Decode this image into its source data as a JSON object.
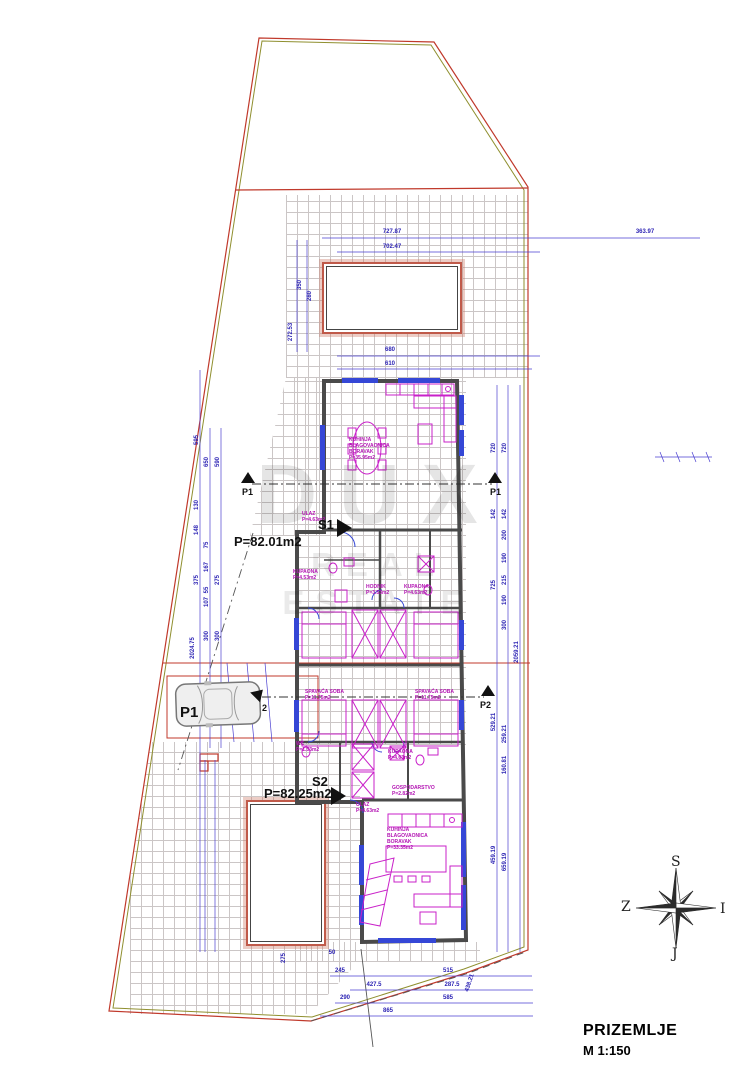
{
  "drawing": {
    "floor_label": "PRIZEMLJE",
    "scale_label": "M 1:150"
  },
  "watermark": {
    "brand": "DUX",
    "tagline": "REAL ESTATE"
  },
  "compass": {
    "north": "S",
    "west": "Z",
    "east": "I",
    "south": "J"
  },
  "units": [
    {
      "id": "S1",
      "area": "P=82.01m2"
    },
    {
      "id": "S2",
      "area": "P=82.25m2"
    }
  ],
  "parking": {
    "space": "P1"
  },
  "sections": {
    "p1": "P1",
    "p2": "P2",
    "entry": "2"
  },
  "colors": {
    "boundary_red": "#c0392b",
    "boundary_olive": "#8f8f2f",
    "wall": "#4a4a4a",
    "furniture": "#c920c9",
    "dimension": "#3d30c4",
    "window": "#3547d6",
    "hatch": "#cbc6c6",
    "watermark": "#cfcfcf"
  },
  "rooms": [
    {
      "t": "KUHINJA\nBLAGOVAONICA\nBORAVAK\nP=35.95m2",
      "x": 349,
      "y": 438
    },
    {
      "t": "ULAZ\nP=4.63m2",
      "x": 302,
      "y": 512
    },
    {
      "t": "KUPAONA\nP=4.53m2",
      "x": 293,
      "y": 570
    },
    {
      "t": "HODNIK\nP=3.53m2",
      "x": 366,
      "y": 585
    },
    {
      "t": "KUPAONA\nP=4.63m2",
      "x": 404,
      "y": 585
    },
    {
      "t": "SPAVAĆA SOBA\nP=11.75m2",
      "x": 305,
      "y": 690
    },
    {
      "t": "SPAVAĆA SOBA\nP=11.75m2",
      "x": 415,
      "y": 690
    },
    {
      "t": "WC\nP=1.53m2",
      "x": 296,
      "y": 742
    },
    {
      "t": "KUPAONA\nP=4.63m2",
      "x": 388,
      "y": 750
    },
    {
      "t": "GOSPODARSTVO\nP=2.82m2",
      "x": 392,
      "y": 786
    },
    {
      "t": "ULAZ\nP=4.63m2",
      "x": 356,
      "y": 803
    },
    {
      "t": "KUHINJA\nBLAGOVAONICA\nBORAVAK\nP=33.35m2",
      "x": 387,
      "y": 828
    }
  ],
  "dims": [
    {
      "t": "727.87",
      "x": 392,
      "y": 232,
      "r": 0
    },
    {
      "t": "702.47",
      "x": 392,
      "y": 247,
      "r": 0
    },
    {
      "t": "363.97",
      "x": 645,
      "y": 232,
      "r": 0
    },
    {
      "t": "680",
      "x": 390,
      "y": 350,
      "r": 0
    },
    {
      "t": "610",
      "x": 390,
      "y": 364,
      "r": 0
    },
    {
      "t": "272.53",
      "x": 291,
      "y": 332,
      "r": -90
    },
    {
      "t": "350",
      "x": 300,
      "y": 285,
      "r": -90
    },
    {
      "t": "280",
      "x": 310,
      "y": 296,
      "r": -90
    },
    {
      "t": "595",
      "x": 197,
      "y": 440,
      "r": -90
    },
    {
      "t": "650",
      "x": 207,
      "y": 462,
      "r": -90
    },
    {
      "t": "590",
      "x": 218,
      "y": 462,
      "r": -90
    },
    {
      "t": "130",
      "x": 197,
      "y": 505,
      "r": -90
    },
    {
      "t": "148",
      "x": 197,
      "y": 530,
      "r": -90
    },
    {
      "t": "75",
      "x": 207,
      "y": 545,
      "r": -90
    },
    {
      "t": "167",
      "x": 207,
      "y": 567,
      "r": -90
    },
    {
      "t": "375",
      "x": 197,
      "y": 580,
      "r": -90
    },
    {
      "t": "275",
      "x": 218,
      "y": 580,
      "r": -90
    },
    {
      "t": "55",
      "x": 207,
      "y": 590,
      "r": -90
    },
    {
      "t": "107",
      "x": 207,
      "y": 602,
      "r": -90
    },
    {
      "t": "300",
      "x": 207,
      "y": 636,
      "r": -90
    },
    {
      "t": "300",
      "x": 218,
      "y": 636,
      "r": -90
    },
    {
      "t": "2024.75",
      "x": 193,
      "y": 648,
      "r": -90
    },
    {
      "t": "720",
      "x": 494,
      "y": 448,
      "r": -90
    },
    {
      "t": "720",
      "x": 505,
      "y": 448,
      "r": -90
    },
    {
      "t": "142",
      "x": 494,
      "y": 514,
      "r": -90
    },
    {
      "t": "142",
      "x": 505,
      "y": 514,
      "r": -90
    },
    {
      "t": "200",
      "x": 505,
      "y": 535,
      "r": -90
    },
    {
      "t": "190",
      "x": 505,
      "y": 558,
      "r": -90
    },
    {
      "t": "215",
      "x": 505,
      "y": 580,
      "r": -90
    },
    {
      "t": "725",
      "x": 494,
      "y": 585,
      "r": -90
    },
    {
      "t": "190",
      "x": 505,
      "y": 600,
      "r": -90
    },
    {
      "t": "300",
      "x": 505,
      "y": 625,
      "r": -90
    },
    {
      "t": "2059.21",
      "x": 517,
      "y": 652,
      "r": -90
    },
    {
      "t": "529.21",
      "x": 494,
      "y": 722,
      "r": -90
    },
    {
      "t": "259.21",
      "x": 505,
      "y": 734,
      "r": -90
    },
    {
      "t": "160.81",
      "x": 505,
      "y": 765,
      "r": -90
    },
    {
      "t": "459.19",
      "x": 494,
      "y": 855,
      "r": -90
    },
    {
      "t": "659.19",
      "x": 505,
      "y": 862,
      "r": -90
    },
    {
      "t": "245",
      "x": 340,
      "y": 971,
      "r": 0
    },
    {
      "t": "515",
      "x": 448,
      "y": 971,
      "r": 0
    },
    {
      "t": "427.5",
      "x": 374,
      "y": 985,
      "r": 0
    },
    {
      "t": "287.5",
      "x": 452,
      "y": 985,
      "r": 0
    },
    {
      "t": "290",
      "x": 345,
      "y": 998,
      "r": 0
    },
    {
      "t": "585",
      "x": 448,
      "y": 998,
      "r": 0
    },
    {
      "t": "865",
      "x": 388,
      "y": 1011,
      "r": 0
    },
    {
      "t": "438.21",
      "x": 470,
      "y": 983,
      "r": -72
    },
    {
      "t": "50",
      "x": 332,
      "y": 953,
      "r": 0
    },
    {
      "t": "275",
      "x": 284,
      "y": 958,
      "r": -90
    }
  ]
}
